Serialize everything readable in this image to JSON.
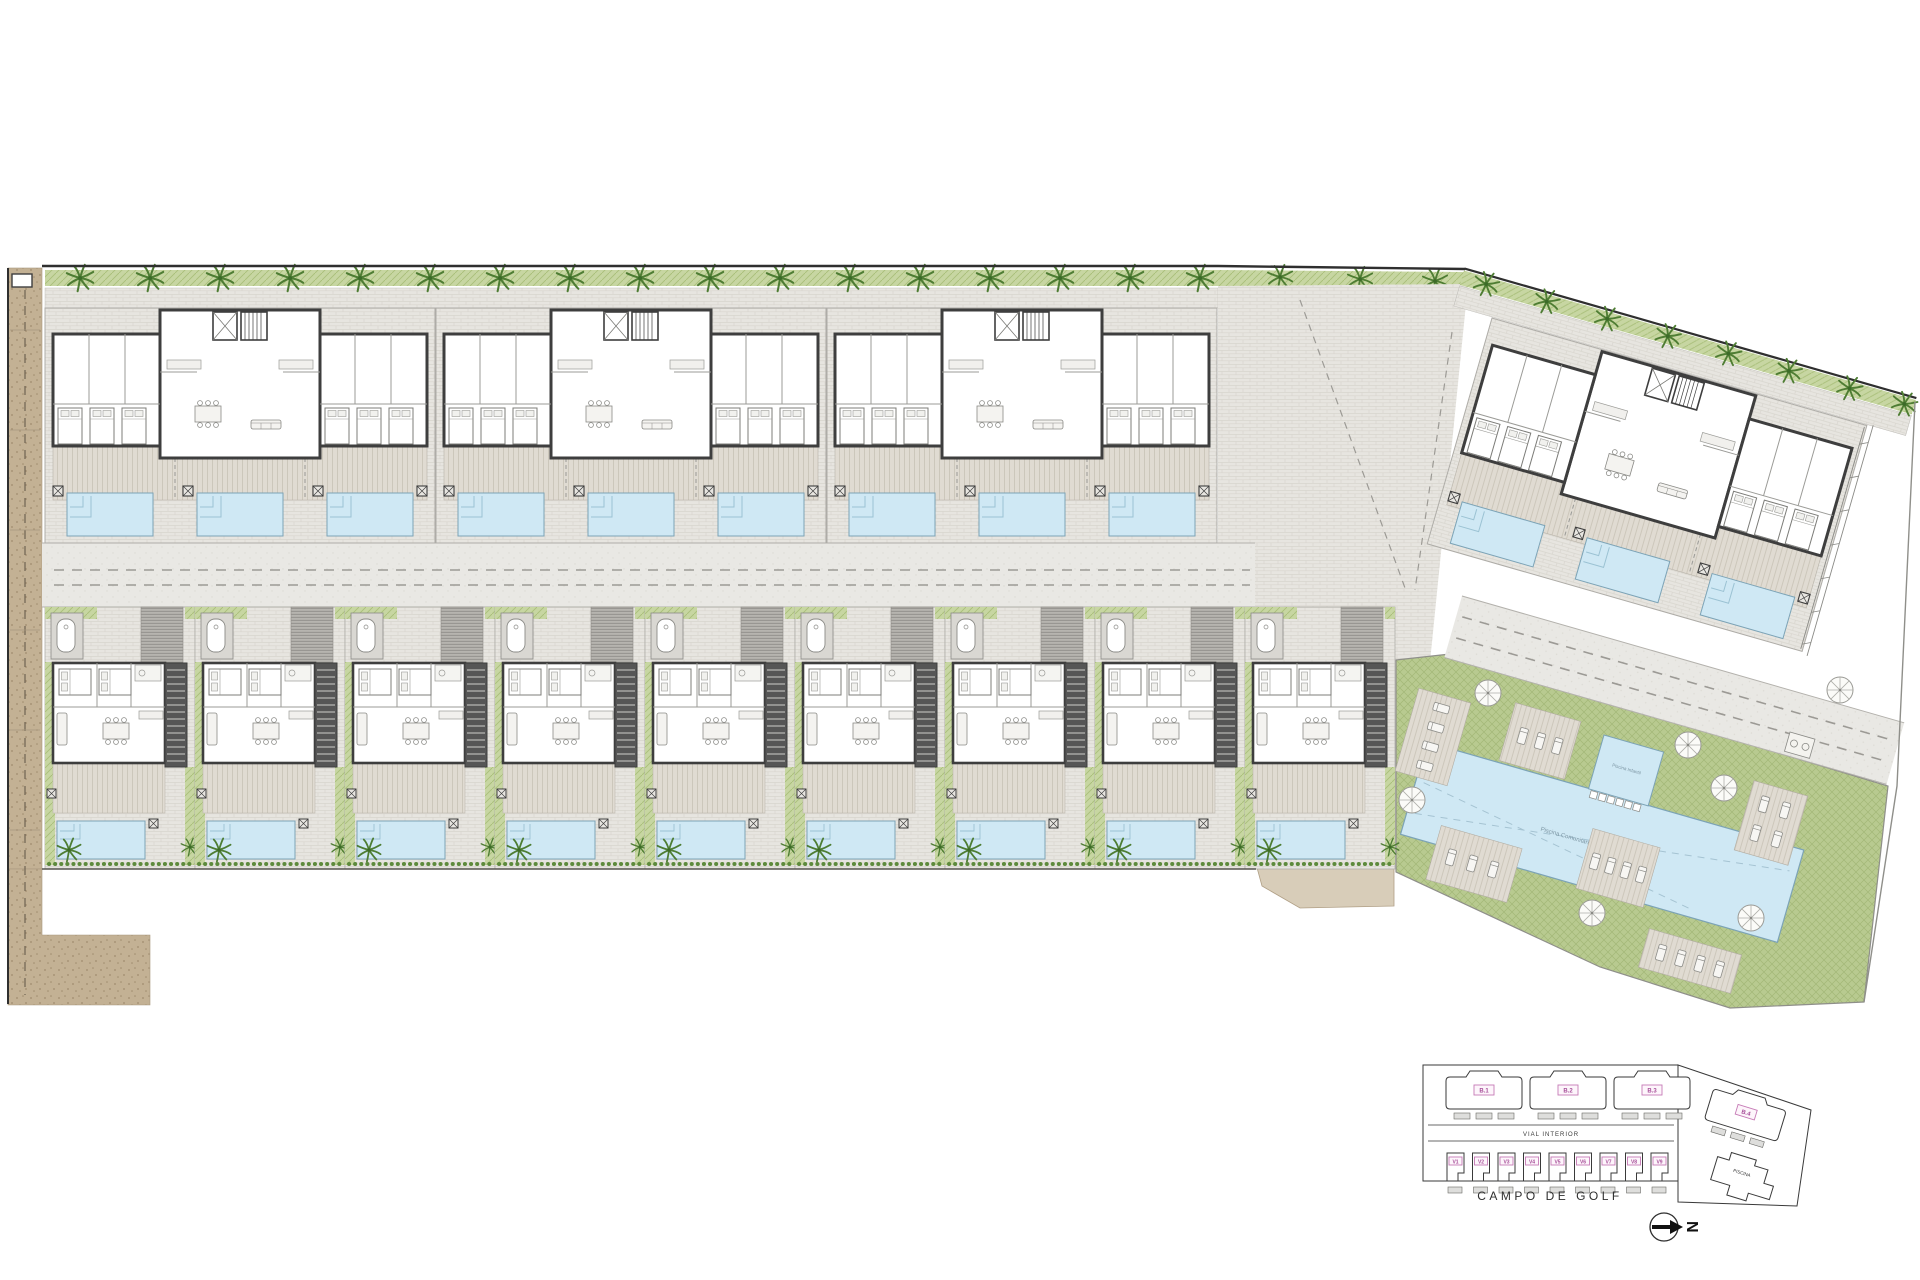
{
  "keyplan": {
    "block_labels": [
      "B.1",
      "B.2",
      "B.3",
      "B.4"
    ],
    "villa_labels": [
      "V1",
      "V2",
      "V3",
      "V4",
      "V5",
      "V6",
      "V7",
      "V8",
      "V9"
    ],
    "road_label": "VIAL INTERIOR",
    "pool_building_label": "PISCINA",
    "golf_label": "CAMPO DE GOLF",
    "north_letter": "N"
  },
  "communal": {
    "main_pool_label": "Piscina Comunitaria",
    "kids_pool_label": "Piscina Infantil"
  },
  "colors": {
    "pool_water": "#cfe8f4",
    "lawn_green": "#b8ca90",
    "hedge_green": "#c7d6a2",
    "wall_dark": "#3e3e3e",
    "road_grey": "#e9e8e4",
    "gravel_tan": "#c3b194",
    "deck_beige": "#dfdad1",
    "label_magenta": "#a8509a"
  }
}
